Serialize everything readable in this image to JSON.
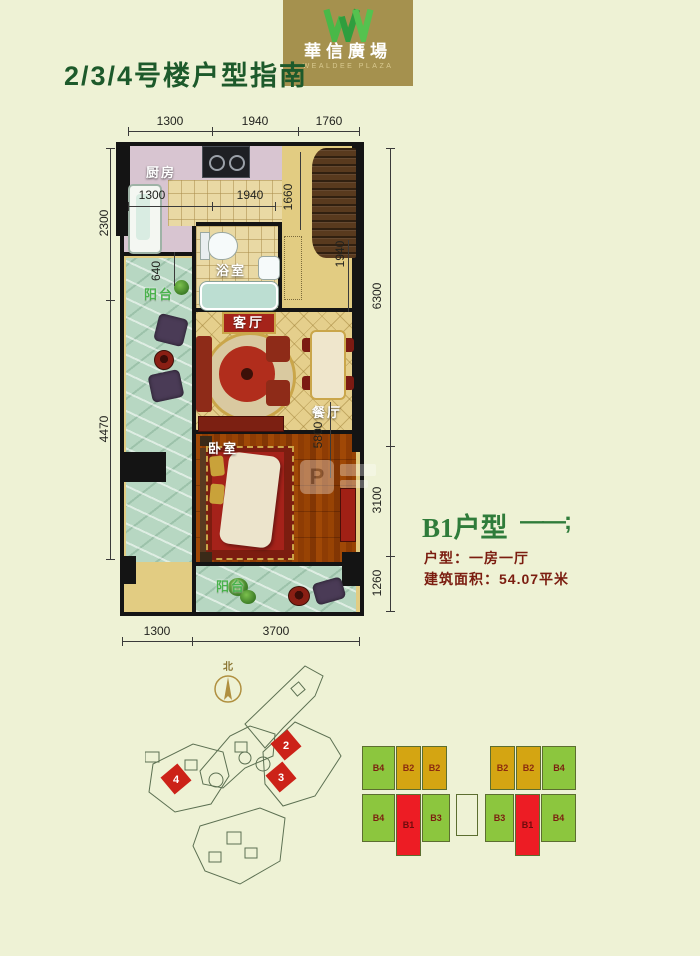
{
  "logo": {
    "monogram": "W-ribbon-logo",
    "brand_cn": "華信廣場",
    "brand_en": "WEALDEE PLAZA",
    "gold": "#a5914e",
    "green": "#49b848"
  },
  "header": {
    "title": "2/3/4号楼户型指南"
  },
  "plan": {
    "labels": {
      "kitchen": "厨房",
      "bathroom": "浴室",
      "balcony_left": "阳台",
      "living": "客厅",
      "dining": "餐厅",
      "bedroom": "卧室",
      "balcony_bottom": "阳台"
    },
    "dims": {
      "top": [
        "1300",
        "1940",
        "1760"
      ],
      "left": [
        "2300",
        "4470"
      ],
      "right": [
        "6300",
        "3100",
        "1260"
      ],
      "bottom": [
        "1300",
        "3700"
      ],
      "inner": {
        "kitchen_a": "1300",
        "kitchen_b": "1940",
        "kitchen_c": "640",
        "foyer": "1660",
        "hall": "1940",
        "living": "5800"
      }
    }
  },
  "unit_info": {
    "title": "B1户型",
    "dash": "——;",
    "type_line": "户型：一房一厅",
    "area_line": "建筑面积：54.07平米",
    "accent_green": "#2f7c3a",
    "accent_maroon": "#7b1d10"
  },
  "site_map": {
    "north": "北",
    "highlights": [
      "2",
      "3",
      "4"
    ]
  },
  "floor_key": {
    "colors": {
      "green": "#8cc63e",
      "gold": "#d4a512",
      "red": "#ed1c24"
    },
    "units": [
      {
        "label": "B4",
        "color": "green"
      },
      {
        "label": "B2",
        "color": "gold"
      },
      {
        "label": "B2",
        "color": "gold"
      },
      {
        "label": "B2",
        "color": "gold"
      },
      {
        "label": "B2",
        "color": "gold"
      },
      {
        "label": "B4",
        "color": "green"
      },
      {
        "label": "B4",
        "color": "green"
      },
      {
        "label": "B1",
        "color": "red"
      },
      {
        "label": "B3",
        "color": "green"
      },
      {
        "label": "B3",
        "color": "green"
      },
      {
        "label": "B1",
        "color": "red"
      },
      {
        "label": "B4",
        "color": "green"
      }
    ]
  },
  "watermark": {
    "letter": "P"
  }
}
